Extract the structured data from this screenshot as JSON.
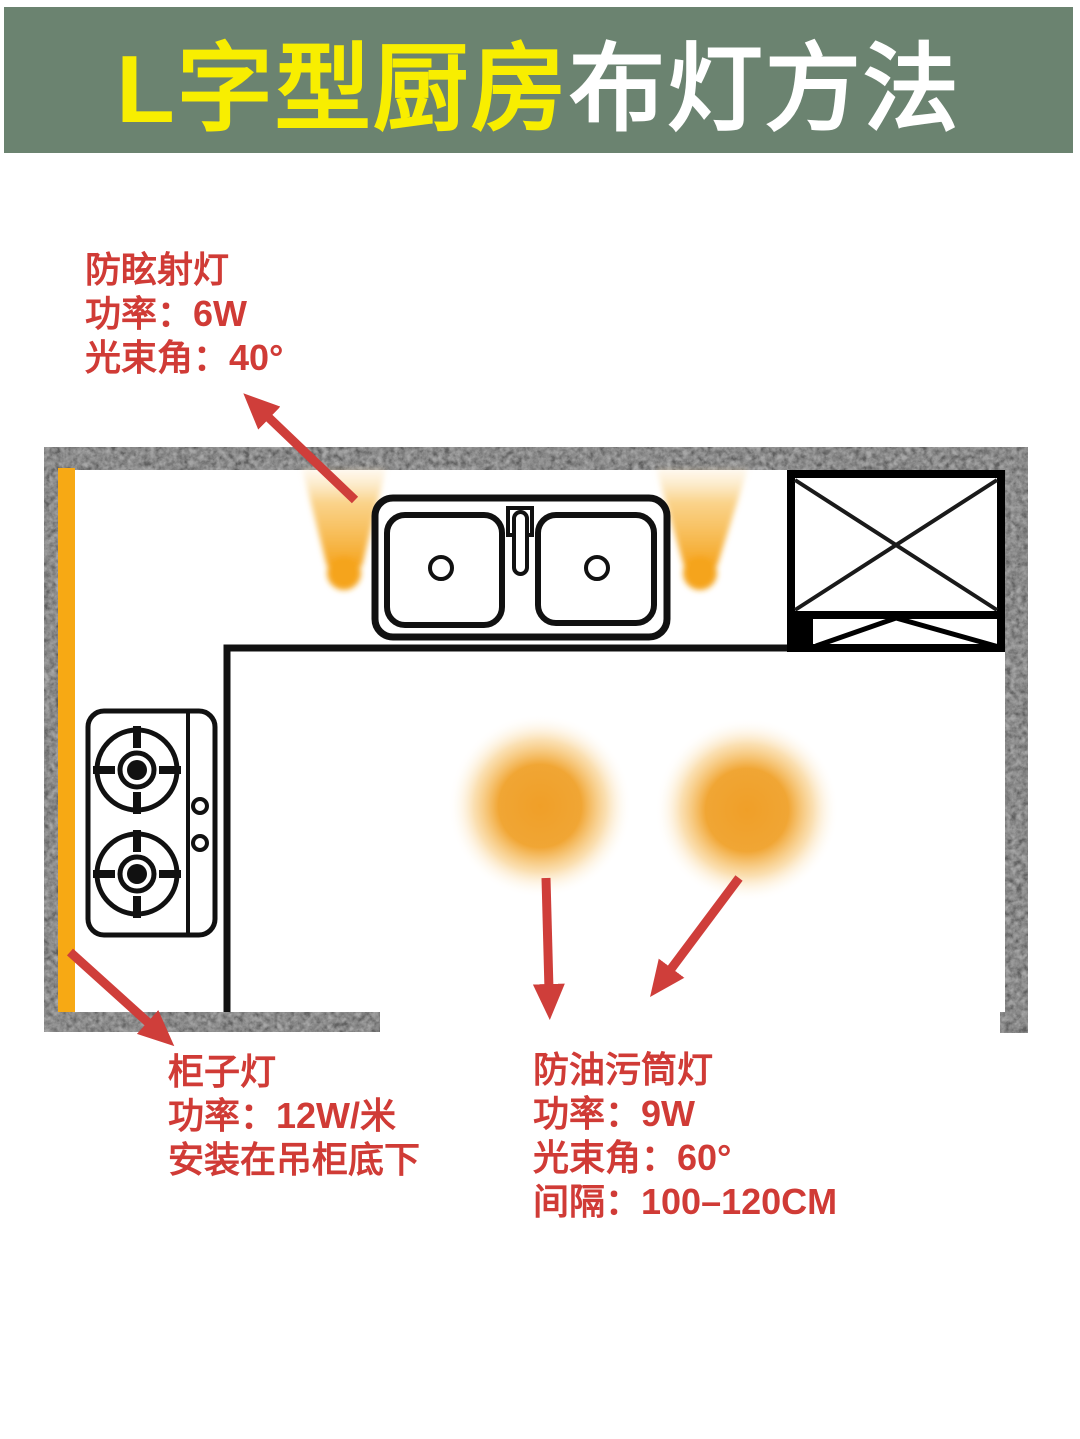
{
  "banner": {
    "title_highlight": "L字型厨房",
    "title_rest": "布灯方法"
  },
  "annotations": {
    "spotlight": {
      "lines": [
        "防眩射灯",
        "功率：6W",
        "光束角：40°"
      ]
    },
    "cabinet_light": {
      "lines": [
        "柜子灯",
        "功率：12W/米",
        "安装在吊柜底下"
      ]
    },
    "downlight": {
      "lines": [
        "防油污筒灯",
        "功率：9W",
        "光束角：60°",
        "间隔：100–120CM"
      ]
    }
  },
  "plan": {
    "elements": {
      "sink": "double-basin-sink-top-view",
      "stove": "two-burner-gas-stove-top-view",
      "tall_cabinet": "crossed-box-cabinet-symbol",
      "strip_light": "orange-cabinet-strip-light",
      "spotlights": "two-anti-glare-spotlight-beams",
      "downlights": "two-glowing-ceiling-downlights",
      "walls": "concrete-textured-l-shape-walls"
    }
  },
  "colors": {
    "banner_green": "#6b8370",
    "title_yellow": "#f8ee00",
    "title_white": "#ffffff",
    "wall_gray": "#a8a8a8",
    "light_orange": "#f5a41f",
    "strip_orange": "#f7a914",
    "red_text": "#d03b36",
    "arrow_red": "#cf3e3a",
    "outline_black": "#111111"
  }
}
